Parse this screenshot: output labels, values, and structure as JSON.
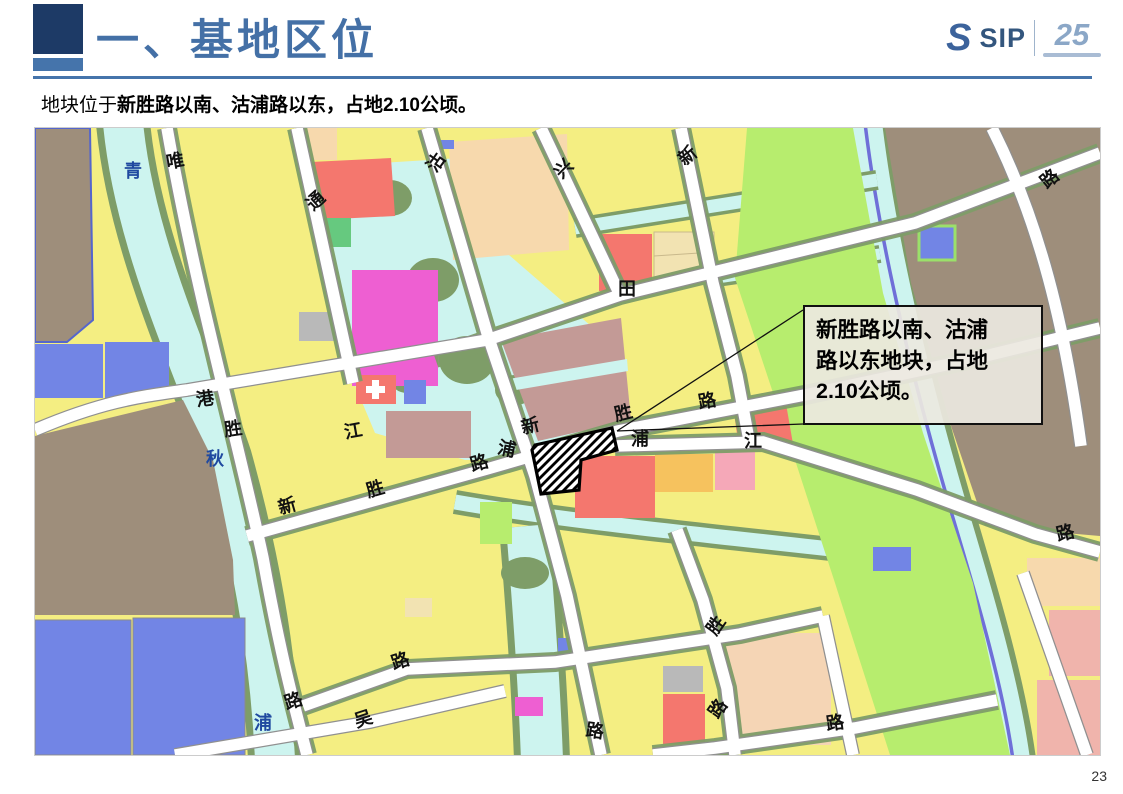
{
  "slide": {
    "title": "一、基地区位",
    "subtitle_prefix": "地块位于",
    "subtitle_bold": "新胜路以南、沽浦路以东，占地2.10公顷。",
    "page_number": "23"
  },
  "logo": {
    "swoosh": "S",
    "name": "SIP",
    "anniversary": "25"
  },
  "callout": {
    "line1": "新胜路以南、沽浦",
    "line2": "路以东地块，占地",
    "line3": "2.10公顷。"
  },
  "map": {
    "palette": {
      "residential_yellow": "#f4ee82",
      "village_brown": "#9e8e7b",
      "industrial_blue": "#7285e5",
      "commercial_red": "#f4776e",
      "entertainment_magenta": "#ee5fd2",
      "education_mauve": "#c39a96",
      "public_peach": "#f7d9ad",
      "cream": "#f2e3b2",
      "park_green": "#66c97f",
      "farmland_green": "#b7ed6e",
      "water_cyan": "#cdf4ef",
      "river_line_violet": "#6f6fd8",
      "bank_sage": "#7e9d68",
      "municipal_gray": "#b9b9b9",
      "pink": "#f5a8b8",
      "orange": "#f6c25e",
      "road_white": "#ffffff"
    },
    "labels": [
      {
        "t": "唯",
        "x": 140,
        "y": 32,
        "r": -10,
        "k": "road"
      },
      {
        "t": "通",
        "x": 280,
        "y": 72,
        "r": -42,
        "k": "road"
      },
      {
        "t": "沽",
        "x": 400,
        "y": 34,
        "r": -55,
        "k": "road"
      },
      {
        "t": "兴",
        "x": 528,
        "y": 40,
        "r": -45,
        "k": "road"
      },
      {
        "t": "新",
        "x": 652,
        "y": 27,
        "r": -40,
        "k": "road"
      },
      {
        "t": "路",
        "x": 1014,
        "y": 50,
        "r": -40,
        "k": "road"
      },
      {
        "t": "田",
        "x": 592,
        "y": 160,
        "r": 0,
        "k": "road"
      },
      {
        "t": "港",
        "x": 170,
        "y": 270,
        "r": -8,
        "k": "road"
      },
      {
        "t": "胜",
        "x": 198,
        "y": 300,
        "r": -8,
        "k": "road"
      },
      {
        "t": "江",
        "x": 318,
        "y": 302,
        "r": -10,
        "k": "road"
      },
      {
        "t": "新",
        "x": 252,
        "y": 377,
        "r": -16,
        "k": "road"
      },
      {
        "t": "胜",
        "x": 340,
        "y": 360,
        "r": -16,
        "k": "road"
      },
      {
        "t": "路",
        "x": 444,
        "y": 334,
        "r": -16,
        "k": "road"
      },
      {
        "t": "浦",
        "x": 472,
        "y": 320,
        "r": 12,
        "k": "road"
      },
      {
        "t": "新",
        "x": 495,
        "y": 297,
        "r": -14,
        "k": "road"
      },
      {
        "t": "胜",
        "x": 588,
        "y": 284,
        "r": -14,
        "k": "road"
      },
      {
        "t": "路",
        "x": 672,
        "y": 272,
        "r": -10,
        "k": "road"
      },
      {
        "t": "浦",
        "x": 605,
        "y": 310,
        "r": 0,
        "k": "road"
      },
      {
        "t": "江",
        "x": 718,
        "y": 312,
        "r": 0,
        "k": "road"
      },
      {
        "t": "路",
        "x": 1030,
        "y": 404,
        "r": -14,
        "k": "road"
      },
      {
        "t": "胜",
        "x": 680,
        "y": 497,
        "r": -55,
        "k": "road"
      },
      {
        "t": "路",
        "x": 682,
        "y": 580,
        "r": -55,
        "k": "road"
      },
      {
        "t": "路",
        "x": 800,
        "y": 594,
        "r": -8,
        "k": "road"
      },
      {
        "t": "吴",
        "x": 328,
        "y": 590,
        "r": -18,
        "k": "road"
      },
      {
        "t": "路",
        "x": 365,
        "y": 532,
        "r": -18,
        "k": "road"
      },
      {
        "t": "路",
        "x": 258,
        "y": 572,
        "r": -18,
        "k": "road"
      },
      {
        "t": "路",
        "x": 560,
        "y": 602,
        "r": 8,
        "k": "road"
      },
      {
        "t": "青",
        "x": 98,
        "y": 42,
        "r": 0,
        "k": "river"
      },
      {
        "t": "秋",
        "x": 180,
        "y": 330,
        "r": 0,
        "k": "river"
      },
      {
        "t": "浦",
        "x": 228,
        "y": 594,
        "r": 0,
        "k": "river"
      }
    ]
  }
}
